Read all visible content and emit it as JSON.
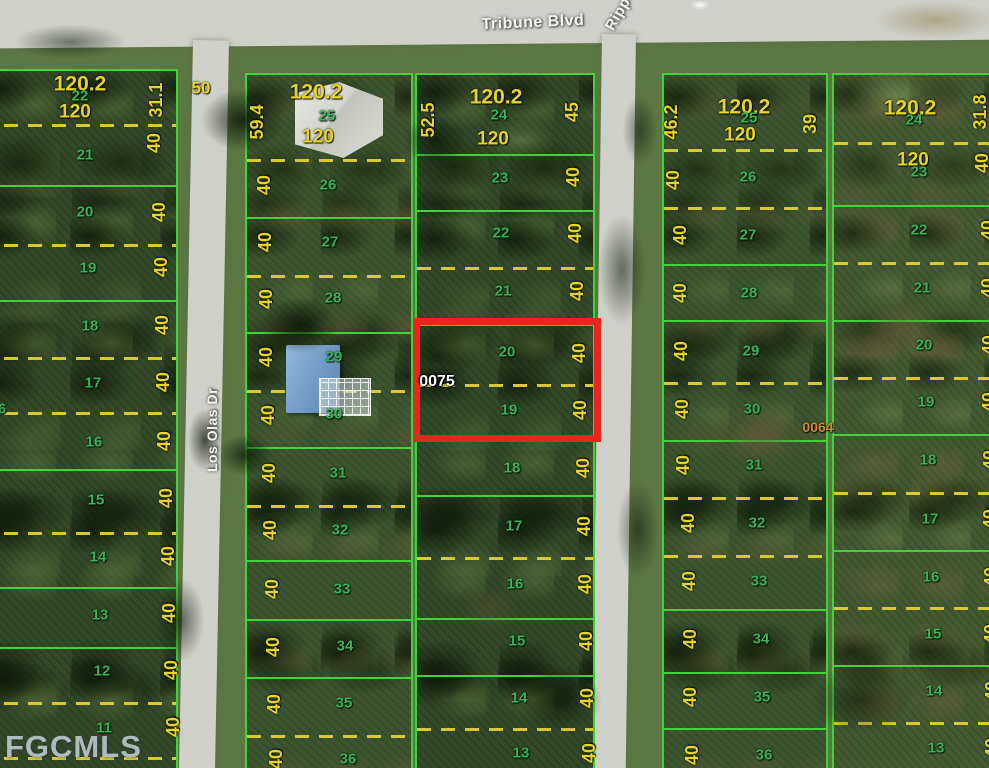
{
  "map": {
    "title_note": "aerial parcel map with highlighted lot",
    "colors": {
      "highlight_red": "#e8261d",
      "line_green": "#3ed336",
      "dash_yellow": "#d9c832",
      "lot_number_green": "#35b757",
      "dimension_yellow": "#e8d51f"
    },
    "watermark": "FGCMLS",
    "highlighted_parcel": {
      "lots": [
        "20",
        "19"
      ],
      "reference_number": "0075",
      "dimensions": [
        "40",
        "40"
      ]
    },
    "streets": [
      {
        "name": "Tribune Blvd",
        "x": 533,
        "y": 23,
        "rot": -2.5,
        "size": 16
      },
      {
        "name": "Ripp",
        "x": 618,
        "y": 14,
        "rot": -60,
        "size": 15
      },
      {
        "name": "Los Olas Dr",
        "x": 212,
        "y": 430,
        "rot": -90,
        "size": 14
      }
    ],
    "blocks": [
      {
        "id": "west",
        "x": -22,
        "y": 69,
        "w": 200,
        "h": 706,
        "tex": "a",
        "seps": [
          {
            "y": 122,
            "t": "d"
          },
          {
            "y": 183,
            "t": "s"
          },
          {
            "y": 242,
            "t": "d"
          },
          {
            "y": 298,
            "t": "s"
          },
          {
            "y": 355,
            "t": "d"
          },
          {
            "y": 410,
            "t": "d"
          },
          {
            "y": 467,
            "t": "s"
          },
          {
            "y": 530,
            "t": "d"
          },
          {
            "y": 585,
            "t": "s"
          },
          {
            "y": 645,
            "t": "s"
          },
          {
            "y": 700,
            "t": "d"
          },
          {
            "y": 755,
            "t": "d"
          }
        ]
      },
      {
        "id": "center-west",
        "x": 245,
        "y": 73,
        "w": 168,
        "h": 700,
        "tex": "b",
        "seps": [
          {
            "y": 157,
            "t": "d"
          },
          {
            "y": 215,
            "t": "s"
          },
          {
            "y": 273,
            "t": "d"
          },
          {
            "y": 330,
            "t": "s"
          },
          {
            "y": 388,
            "t": "d"
          },
          {
            "y": 445,
            "t": "s"
          },
          {
            "y": 503,
            "t": "d"
          },
          {
            "y": 558,
            "t": "s"
          },
          {
            "y": 617,
            "t": "s"
          },
          {
            "y": 675,
            "t": "s"
          },
          {
            "y": 733,
            "t": "d"
          }
        ]
      },
      {
        "id": "center-east",
        "x": 415,
        "y": 73,
        "w": 180,
        "h": 700,
        "tex": "a",
        "seps": [
          {
            "y": 152,
            "t": "s"
          },
          {
            "y": 208,
            "t": "s"
          },
          {
            "y": 265,
            "t": "d"
          },
          {
            "y": 322,
            "t": "s"
          },
          {
            "y": 382,
            "t": "d"
          },
          {
            "y": 438,
            "t": "s"
          },
          {
            "y": 493,
            "t": "s"
          },
          {
            "y": 555,
            "t": "d"
          },
          {
            "y": 616,
            "t": "s"
          },
          {
            "y": 673,
            "t": "s"
          },
          {
            "y": 726,
            "t": "d"
          }
        ]
      },
      {
        "id": "east-west",
        "x": 662,
        "y": 73,
        "w": 166,
        "h": 700,
        "tex": "b",
        "seps": [
          {
            "y": 147,
            "t": "d"
          },
          {
            "y": 205,
            "t": "d"
          },
          {
            "y": 262,
            "t": "s"
          },
          {
            "y": 318,
            "t": "s"
          },
          {
            "y": 380,
            "t": "d"
          },
          {
            "y": 438,
            "t": "s"
          },
          {
            "y": 495,
            "t": "d"
          },
          {
            "y": 553,
            "t": "d"
          },
          {
            "y": 607,
            "t": "s"
          },
          {
            "y": 670,
            "t": "s"
          },
          {
            "y": 726,
            "t": "s"
          }
        ]
      },
      {
        "id": "east-east",
        "x": 832,
        "y": 73,
        "w": 175,
        "h": 700,
        "tex": "c",
        "seps": [
          {
            "y": 140,
            "t": "d"
          },
          {
            "y": 203,
            "t": "s"
          },
          {
            "y": 260,
            "t": "d"
          },
          {
            "y": 318,
            "t": "s"
          },
          {
            "y": 375,
            "t": "d"
          },
          {
            "y": 432,
            "t": "s"
          },
          {
            "y": 490,
            "t": "d"
          },
          {
            "y": 548,
            "t": "s"
          },
          {
            "y": 605,
            "t": "d"
          },
          {
            "y": 663,
            "t": "s"
          },
          {
            "y": 720,
            "t": "d"
          }
        ]
      }
    ],
    "label_format": [
      "text",
      "x",
      "y",
      "kind",
      "rotation",
      "fontSize"
    ],
    "labels": [
      [
        "120.2",
        80,
        84,
        "dimlg"
      ],
      [
        "22",
        80,
        96,
        "lot"
      ],
      [
        "120",
        75,
        112,
        "dimmd"
      ],
      [
        "31.1",
        156,
        100,
        "dim",
        -90
      ],
      [
        "40",
        154,
        143,
        "dim",
        -90
      ],
      [
        "50",
        201,
        88,
        "dim",
        0,
        17
      ],
      [
        "21",
        85,
        155,
        "lot"
      ],
      [
        "20",
        85,
        212,
        "lot"
      ],
      [
        "19",
        88,
        268,
        "lot"
      ],
      [
        "18",
        90,
        326,
        "lot"
      ],
      [
        "17",
        93,
        383,
        "lot"
      ],
      [
        "16",
        94,
        442,
        "lot"
      ],
      [
        "15",
        96,
        500,
        "lot"
      ],
      [
        "14",
        98,
        557,
        "lot"
      ],
      [
        "13",
        100,
        615,
        "lot"
      ],
      [
        "12",
        102,
        671,
        "lot"
      ],
      [
        "11",
        104,
        728,
        "lot"
      ],
      [
        "6",
        2,
        409,
        "lot"
      ],
      [
        "40",
        159,
        212,
        "dim",
        -90
      ],
      [
        "40",
        161,
        267,
        "dim",
        -90
      ],
      [
        "40",
        162,
        325,
        "dim",
        -90
      ],
      [
        "40",
        163,
        382,
        "dim",
        -90
      ],
      [
        "40",
        164,
        441,
        "dim",
        -90
      ],
      [
        "40",
        166,
        498,
        "dim",
        -90
      ],
      [
        "40",
        168,
        556,
        "dim",
        -90
      ],
      [
        "40",
        169,
        613,
        "dim",
        -90
      ],
      [
        "40",
        171,
        670,
        "dim",
        -90
      ],
      [
        "40",
        173,
        727,
        "dim",
        -90
      ],
      [
        "120.2",
        316,
        92,
        "dimlg"
      ],
      [
        "25",
        327,
        116,
        "lot"
      ],
      [
        "120",
        318,
        137,
        "dimmd"
      ],
      [
        "59.4",
        257,
        122,
        "dim",
        -90
      ],
      [
        "40",
        264,
        185,
        "dim",
        -90
      ],
      [
        "40",
        265,
        242,
        "dim",
        -90
      ],
      [
        "40",
        266,
        299,
        "dim",
        -90
      ],
      [
        "40",
        266,
        357,
        "dim",
        -90
      ],
      [
        "40",
        268,
        415,
        "dim",
        -90
      ],
      [
        "40",
        269,
        473,
        "dim",
        -90
      ],
      [
        "40",
        270,
        530,
        "dim",
        -90
      ],
      [
        "40",
        272,
        589,
        "dim",
        -90
      ],
      [
        "40",
        273,
        647,
        "dim",
        -90
      ],
      [
        "40",
        274,
        704,
        "dim",
        -90
      ],
      [
        "40",
        276,
        759,
        "dim",
        -90
      ],
      [
        "26",
        328,
        185,
        "lot"
      ],
      [
        "27",
        330,
        242,
        "lot"
      ],
      [
        "28",
        333,
        298,
        "lot"
      ],
      [
        "29",
        334,
        357,
        "lot"
      ],
      [
        "30",
        334,
        414,
        "lot"
      ],
      [
        "31",
        338,
        473,
        "lot"
      ],
      [
        "32",
        340,
        530,
        "lot"
      ],
      [
        "33",
        342,
        589,
        "lot"
      ],
      [
        "34",
        345,
        646,
        "lot"
      ],
      [
        "35",
        344,
        703,
        "lot"
      ],
      [
        "36",
        348,
        759,
        "lot"
      ],
      [
        "120.2",
        496,
        97,
        "dimlg"
      ],
      [
        "24",
        499,
        115,
        "lot"
      ],
      [
        "120",
        493,
        139,
        "dimmd"
      ],
      [
        "52.5",
        428,
        120,
        "dim",
        -90
      ],
      [
        "45",
        572,
        112,
        "dim",
        -90
      ],
      [
        "23",
        500,
        178,
        "lot"
      ],
      [
        "22",
        501,
        233,
        "lot"
      ],
      [
        "21",
        503,
        291,
        "lot"
      ],
      [
        "20",
        507,
        352,
        "lot"
      ],
      [
        "19",
        509,
        410,
        "lot"
      ],
      [
        "18",
        512,
        468,
        "lot"
      ],
      [
        "17",
        514,
        526,
        "lot"
      ],
      [
        "16",
        515,
        584,
        "lot"
      ],
      [
        "15",
        517,
        641,
        "lot"
      ],
      [
        "14",
        519,
        698,
        "lot"
      ],
      [
        "13",
        521,
        753,
        "lot"
      ],
      [
        "40",
        573,
        177,
        "dim",
        -90
      ],
      [
        "40",
        575,
        233,
        "dim",
        -90
      ],
      [
        "40",
        577,
        291,
        "dim",
        -90
      ],
      [
        "40",
        579,
        353,
        "dim",
        -90
      ],
      [
        "40",
        580,
        410,
        "dim",
        -90
      ],
      [
        "40",
        583,
        468,
        "dim",
        -90
      ],
      [
        "40",
        584,
        526,
        "dim",
        -90
      ],
      [
        "40",
        585,
        584,
        "dim",
        -90
      ],
      [
        "40",
        586,
        641,
        "dim",
        -90
      ],
      [
        "40",
        587,
        698,
        "dim",
        -90
      ],
      [
        "40",
        589,
        753,
        "dim",
        -90
      ],
      [
        "0075",
        437,
        382,
        "ref"
      ],
      [
        "120.2",
        744,
        107,
        "dimlg"
      ],
      [
        "25",
        749,
        118,
        "lot"
      ],
      [
        "120",
        740,
        135,
        "dimmd"
      ],
      [
        "46.2",
        671,
        122,
        "dim",
        -90
      ],
      [
        "39",
        810,
        124,
        "dim",
        -90
      ],
      [
        "40",
        673,
        180,
        "dim",
        -90
      ],
      [
        "40",
        680,
        235,
        "dim",
        -90
      ],
      [
        "40",
        680,
        293,
        "dim",
        -90
      ],
      [
        "40",
        681,
        351,
        "dim",
        -90
      ],
      [
        "40",
        682,
        409,
        "dim",
        -90
      ],
      [
        "40",
        683,
        465,
        "dim",
        -90
      ],
      [
        "40",
        688,
        523,
        "dim",
        -90
      ],
      [
        "40",
        689,
        581,
        "dim",
        -90
      ],
      [
        "40",
        690,
        639,
        "dim",
        -90
      ],
      [
        "40",
        690,
        697,
        "dim",
        -90
      ],
      [
        "40",
        692,
        755,
        "dim",
        -90
      ],
      [
        "26",
        748,
        177,
        "lot"
      ],
      [
        "27",
        748,
        235,
        "lot"
      ],
      [
        "28",
        749,
        293,
        "lot"
      ],
      [
        "29",
        751,
        351,
        "lot"
      ],
      [
        "30",
        752,
        409,
        "lot"
      ],
      [
        "31",
        754,
        465,
        "lot"
      ],
      [
        "32",
        757,
        523,
        "lot"
      ],
      [
        "33",
        759,
        581,
        "lot"
      ],
      [
        "34",
        761,
        639,
        "lot"
      ],
      [
        "35",
        762,
        697,
        "lot"
      ],
      [
        "36",
        764,
        755,
        "lot"
      ],
      [
        "0064",
        818,
        427,
        "ref2"
      ],
      [
        "120.2",
        910,
        108,
        "dimlg"
      ],
      [
        "24",
        914,
        120,
        "lot"
      ],
      [
        "120",
        913,
        160,
        "dimmd"
      ],
      [
        "23",
        919,
        172,
        "lot"
      ],
      [
        "31.8",
        980,
        112,
        "dim",
        -90
      ],
      [
        "40",
        982,
        163,
        "dim",
        -90
      ],
      [
        "22",
        919,
        230,
        "lot"
      ],
      [
        "21",
        922,
        288,
        "lot"
      ],
      [
        "20",
        924,
        345,
        "lot"
      ],
      [
        "19",
        926,
        402,
        "lot"
      ],
      [
        "18",
        928,
        460,
        "lot"
      ],
      [
        "17",
        930,
        519,
        "lot"
      ],
      [
        "16",
        931,
        577,
        "lot"
      ],
      [
        "15",
        933,
        634,
        "lot"
      ],
      [
        "14",
        934,
        691,
        "lot"
      ],
      [
        "13",
        936,
        748,
        "lot"
      ],
      [
        "40",
        988,
        230,
        "dim",
        -90
      ],
      [
        "40",
        988,
        288,
        "dim",
        -90
      ],
      [
        "40",
        989,
        345,
        "dim",
        -90
      ],
      [
        "40",
        989,
        402,
        "dim",
        -90
      ],
      [
        "40",
        990,
        460,
        "dim",
        -90
      ],
      [
        "40",
        990,
        519,
        "dim",
        -90
      ],
      [
        "40",
        991,
        577,
        "dim",
        -90
      ],
      [
        "40",
        991,
        634,
        "dim",
        -90
      ],
      [
        "40",
        992,
        691,
        "dim",
        -90
      ],
      [
        "40",
        992,
        748,
        "dim",
        -90
      ]
    ]
  }
}
